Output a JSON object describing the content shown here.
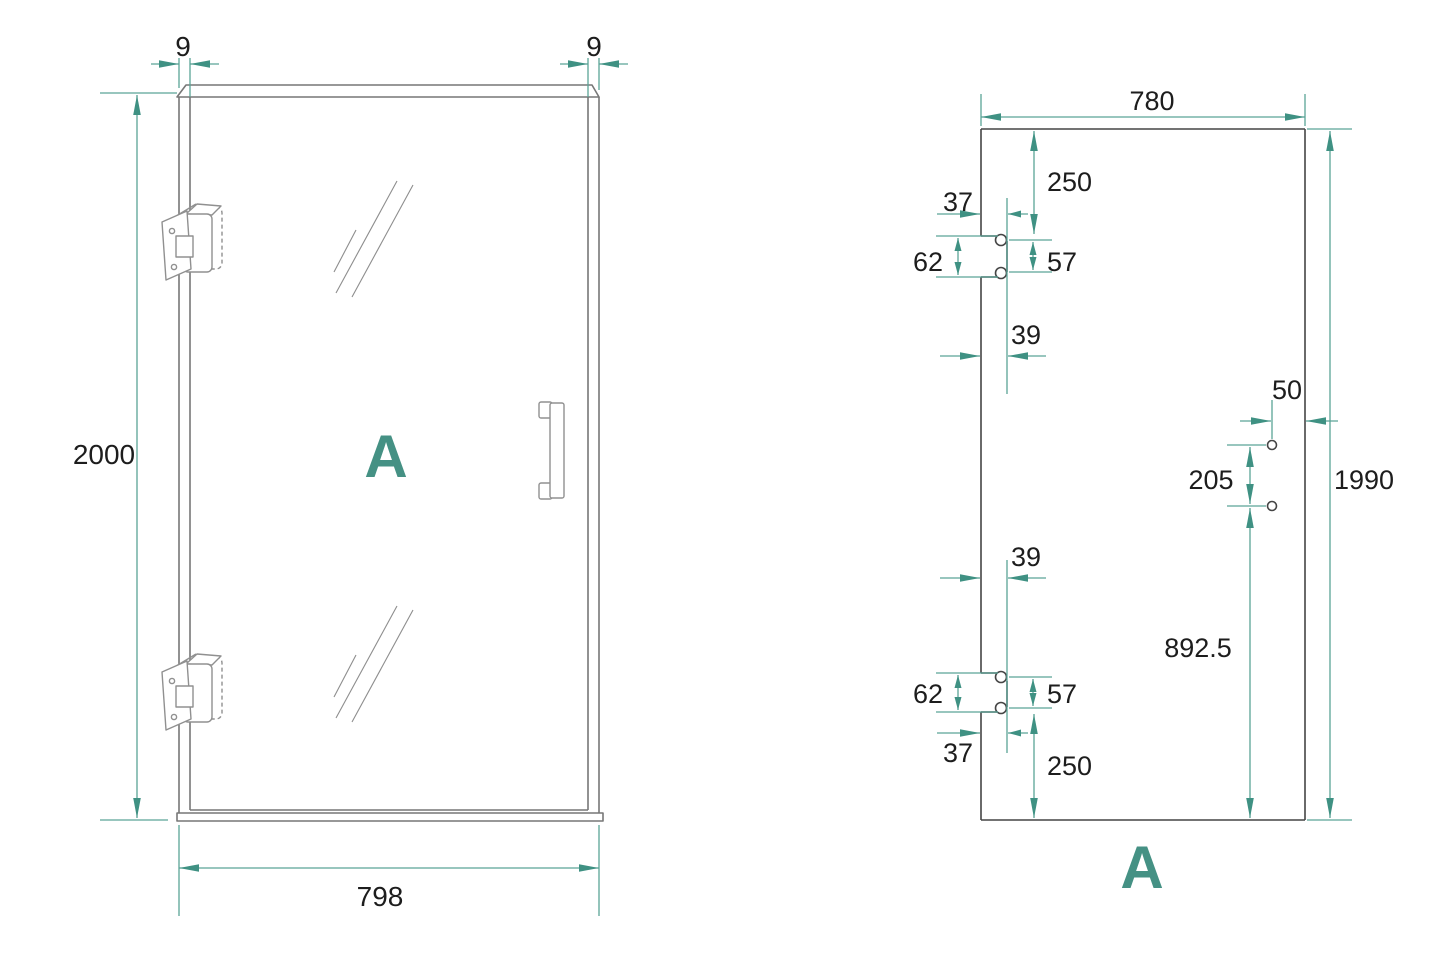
{
  "colors": {
    "accent_teal": "#3F9183",
    "drawing_grey": "#777777",
    "panel_grey": "#454545",
    "text_dark": "#1d1d1d"
  },
  "left_view": {
    "label": "A",
    "dims": {
      "frame_top_left": "9",
      "frame_top_right": "9",
      "height": "2000",
      "width": "798"
    }
  },
  "right_view": {
    "label": "A",
    "dims": {
      "width": "780",
      "height": "1990",
      "top_hinge_from_top": "250",
      "top_hinge_offset": "37",
      "top_hinge_cutout_height": "62",
      "top_hinge_hole_spacing": "57",
      "top_hinge_depth": "39",
      "handle_from_edge": "50",
      "handle_hole_spacing": "205",
      "handle_from_bottom": "892.5",
      "bottom_hinge_depth": "39",
      "bottom_hinge_cutout_height": "62",
      "bottom_hinge_hole_spacing": "57",
      "bottom_hinge_offset": "37",
      "bottom_hinge_from_bottom": "250"
    }
  }
}
